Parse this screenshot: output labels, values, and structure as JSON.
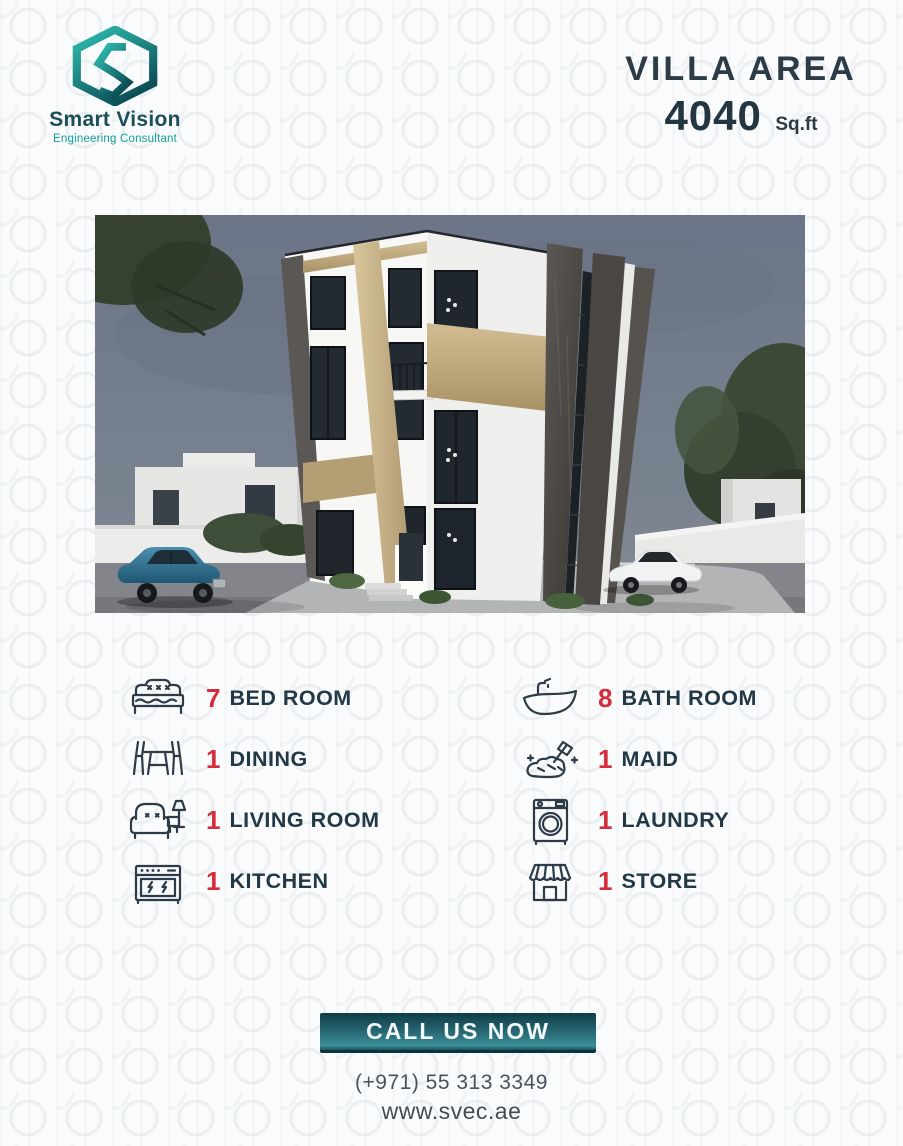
{
  "brand": {
    "name": "Smart Vision",
    "tagline": "Engineering Consultant"
  },
  "header": {
    "title": "VILLA AREA",
    "value": "4040",
    "unit": "Sq.ft"
  },
  "features": {
    "left": [
      {
        "icon": "bed-icon",
        "count": "7",
        "label": "BED ROOM"
      },
      {
        "icon": "dining-icon",
        "count": "1",
        "label": "DINING"
      },
      {
        "icon": "living-room-icon",
        "count": "1",
        "label": "LIVING ROOM"
      },
      {
        "icon": "kitchen-icon",
        "count": "1",
        "label": "KITCHEN"
      }
    ],
    "right": [
      {
        "icon": "bath-icon",
        "count": "8",
        "label": "BATH ROOM"
      },
      {
        "icon": "maid-icon",
        "count": "1",
        "label": "MAID"
      },
      {
        "icon": "laundry-icon",
        "count": "1",
        "label": "LAUNDRY"
      },
      {
        "icon": "store-icon",
        "count": "1",
        "label": "STORE"
      }
    ]
  },
  "cta": {
    "label": "CALL US NOW"
  },
  "contact": {
    "phone": "(+971) 55 313 3349",
    "website": "www.svec.ae"
  },
  "colors": {
    "accent_red": "#d52b3a",
    "navy_text": "#233845",
    "teal_light": "#2fc0b2",
    "teal_dark": "#0c4f57",
    "button_gradient_top": "#0f3d45",
    "button_gradient_bottom": "#3c8e98",
    "sky": "#717b8c",
    "facade_beige": "#bfa87d",
    "stone_dark": "#4a4643"
  }
}
